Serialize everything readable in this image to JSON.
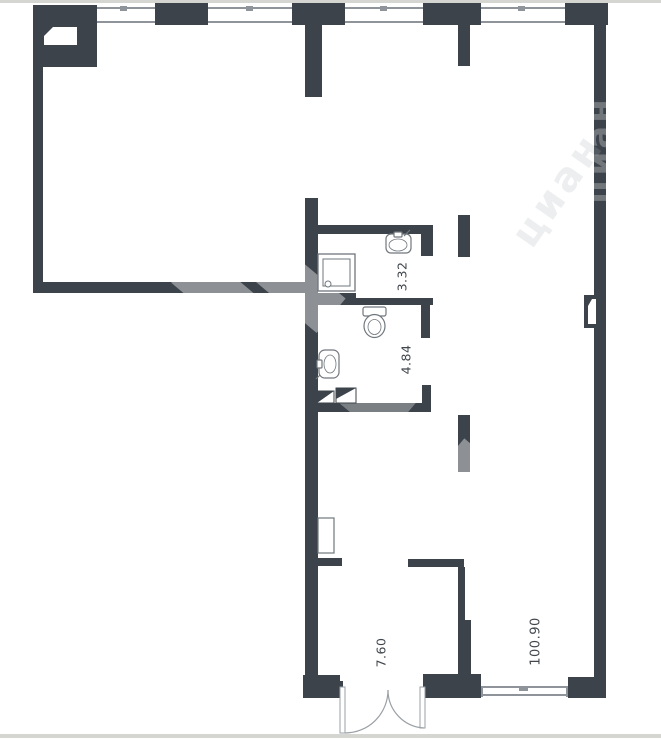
{
  "plan": {
    "kind": "floor-plan",
    "rooms": [
      {
        "id": "bathroom-small",
        "area": "3.32"
      },
      {
        "id": "bathroom-large",
        "area": "4.84"
      },
      {
        "id": "entrance-vestibule",
        "area": "7.60"
      },
      {
        "id": "main-hall",
        "area": "100.90"
      }
    ],
    "watermark_text": "циан",
    "colors": {
      "wall": "#3c434a",
      "window_line": "#8e9499",
      "fixture_line": "#70777d",
      "background": "#ffffff",
      "label_text": "#41474d",
      "photo_edge": "#d5d5d1"
    }
  }
}
